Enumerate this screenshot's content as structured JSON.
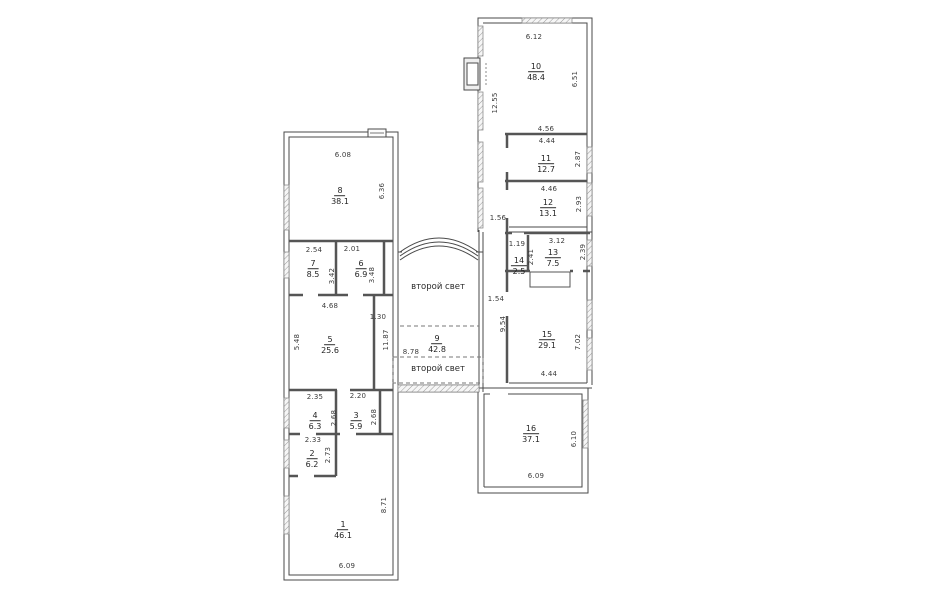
{
  "plan_type": "floor-plan",
  "annotations": {
    "second_light_upper": "второй свет",
    "second_light_lower": "второй свет"
  },
  "colors": {
    "wall_line": "#4a4a4a",
    "partition_line": "#555555",
    "window_hatch": "#9a9a9a",
    "dimension_text": "#3b3b3b",
    "background": "#ffffff"
  },
  "rooms": [
    {
      "number": "1",
      "area": "46.1"
    },
    {
      "number": "2",
      "area": "6.2"
    },
    {
      "number": "3",
      "area": "5.9"
    },
    {
      "number": "4",
      "area": "6.3"
    },
    {
      "number": "5",
      "area": "25.6"
    },
    {
      "number": "6",
      "area": "6.9"
    },
    {
      "number": "7",
      "area": "8.5"
    },
    {
      "number": "8",
      "area": "38.1"
    },
    {
      "number": "9",
      "area": "42.8"
    },
    {
      "number": "10",
      "area": "48.4"
    },
    {
      "number": "11",
      "area": "12.7"
    },
    {
      "number": "12",
      "area": "13.1"
    },
    {
      "number": "13",
      "area": "7.5"
    },
    {
      "number": "14",
      "area": "2.5"
    },
    {
      "number": "15",
      "area": "29.1"
    },
    {
      "number": "16",
      "area": "37.1"
    }
  ],
  "dimensions": [
    {
      "text": "6.12"
    },
    {
      "text": "6.51"
    },
    {
      "text": "12.55"
    },
    {
      "text": "4.56"
    },
    {
      "text": "4.44"
    },
    {
      "text": "2.87"
    },
    {
      "text": "4.46"
    },
    {
      "text": "2.93"
    },
    {
      "text": "1.56"
    },
    {
      "text": "3.12"
    },
    {
      "text": "1.19"
    },
    {
      "text": "2.41"
    },
    {
      "text": "2.39"
    },
    {
      "text": "1.54"
    },
    {
      "text": "9.54"
    },
    {
      "text": "7.02"
    },
    {
      "text": "4.44"
    },
    {
      "text": "6.10"
    },
    {
      "text": "6.09"
    },
    {
      "text": "6.08"
    },
    {
      "text": "6.36"
    },
    {
      "text": "2.54"
    },
    {
      "text": "2.01"
    },
    {
      "text": "3.42"
    },
    {
      "text": "3.48"
    },
    {
      "text": "4.68"
    },
    {
      "text": "5.48"
    },
    {
      "text": "1.30"
    },
    {
      "text": "11.87"
    },
    {
      "text": "8.78"
    },
    {
      "text": "2.35"
    },
    {
      "text": "2.20"
    },
    {
      "text": "2.68"
    },
    {
      "text": "2.68"
    },
    {
      "text": "2.33"
    },
    {
      "text": "2.73"
    },
    {
      "text": "8.71"
    },
    {
      "text": "6.09"
    }
  ]
}
